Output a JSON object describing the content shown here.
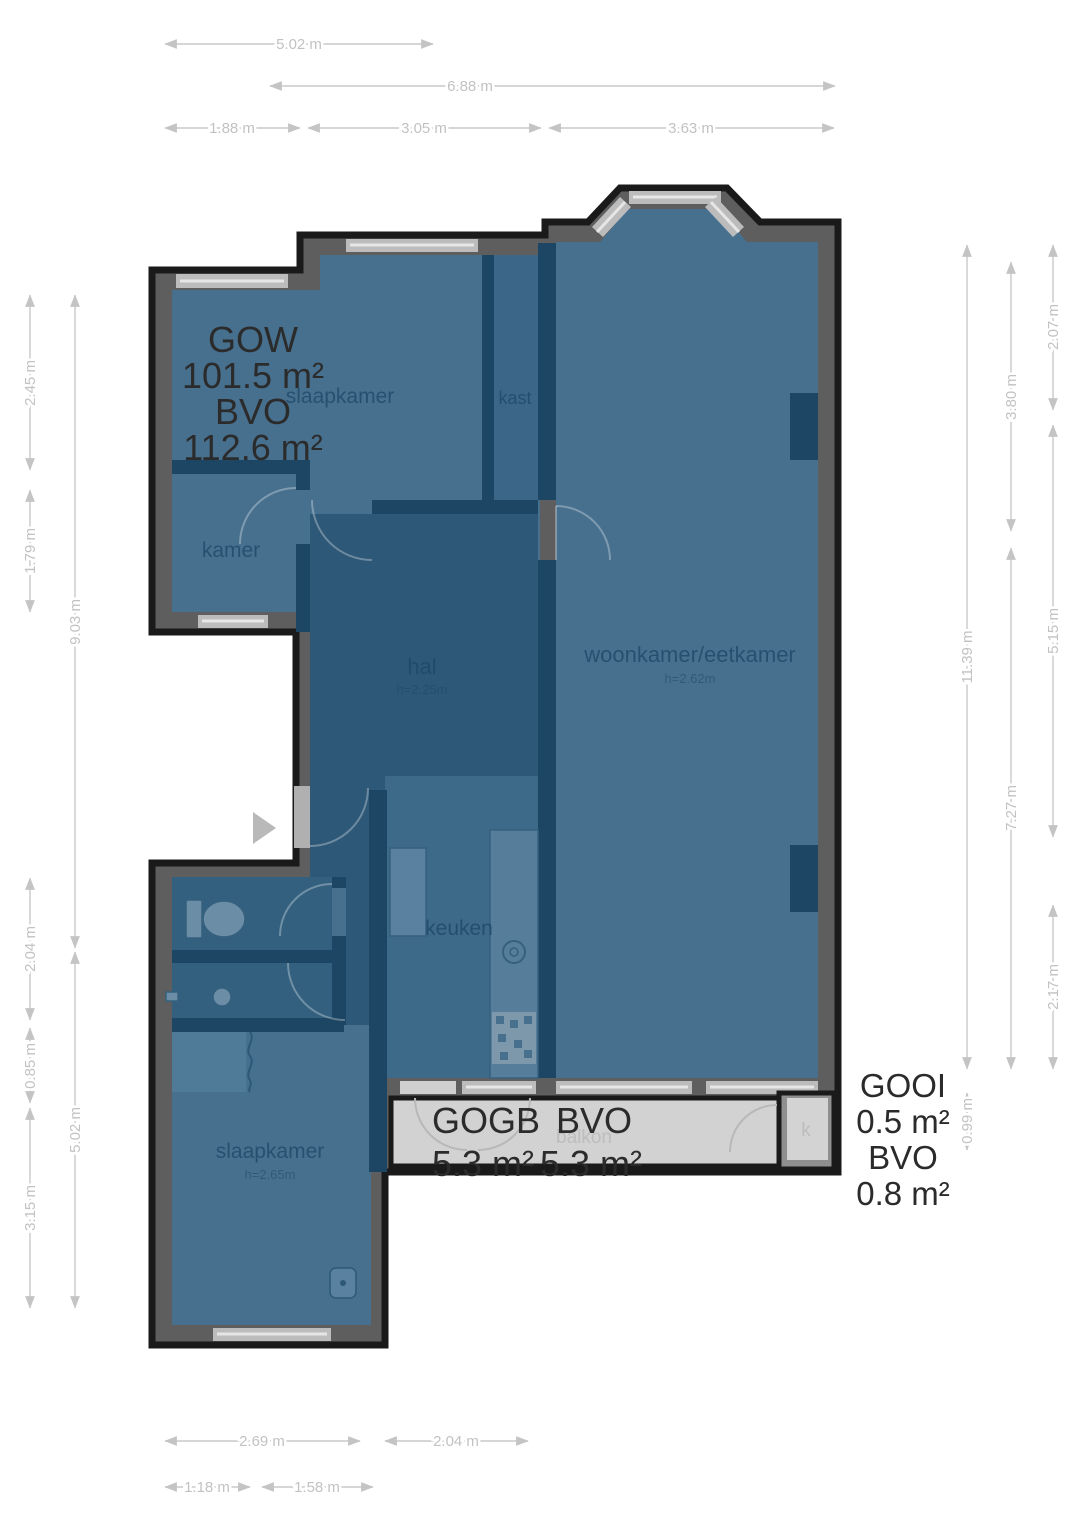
{
  "plan": {
    "area_summary": {
      "gow": [
        "GOW",
        "101.5 m²",
        "BVO",
        "112.6 m²"
      ],
      "gogb": [
        "GOGB",
        "BVO",
        "5.3 m²",
        "5.3 m²"
      ],
      "gooi": [
        "GOOI",
        "0.5 m²",
        "BVO",
        "0.8 m²"
      ]
    },
    "rooms": {
      "slaapkamer_top": {
        "label": "slaapkamer"
      },
      "kast": {
        "label": "kast"
      },
      "kamer": {
        "label": "kamer"
      },
      "hal": {
        "label": "hal",
        "height": "h=2.25m"
      },
      "woonkamer": {
        "label": "woonkamer/eetkamer",
        "height": "h=2.62m"
      },
      "keuken": {
        "label": "keuken"
      },
      "slaapkamer_bottom": {
        "label": "slaapkamer",
        "height": "h=2.65m"
      },
      "balkon": {
        "label": "balkon"
      },
      "berging": {
        "label": "k"
      }
    },
    "dimensions": {
      "top": [
        {
          "label": "5.02 m"
        },
        {
          "label": "6.88 m"
        },
        {
          "label": "1.88 m"
        },
        {
          "label": "3.05 m"
        },
        {
          "label": "3.63 m"
        }
      ],
      "left": [
        {
          "label": "2.45 m"
        },
        {
          "label": "1.79 m"
        },
        {
          "label": "9.03 m"
        },
        {
          "label": "2.04 m"
        },
        {
          "label": "0.85 m"
        },
        {
          "label": "5.02 m"
        },
        {
          "label": "3.15 m"
        }
      ],
      "right": [
        {
          "label": "2.07 m"
        },
        {
          "label": "3.80 m"
        },
        {
          "label": "11.39 m"
        },
        {
          "label": "5.15 m"
        },
        {
          "label": "7.27 m"
        },
        {
          "label": "2.17 m"
        },
        {
          "label": "0.99 m"
        }
      ],
      "bottom": [
        {
          "label": "2.69 m"
        },
        {
          "label": "2.04 m"
        },
        {
          "label": "1.18 m"
        },
        {
          "label": "1.58 m"
        }
      ]
    },
    "colors": {
      "room_fill": "#47708f",
      "hall_fill": "#2e5877",
      "interior_wall": "#1c4663",
      "outer_wall": "#5e5e5e",
      "outline": "#1a1a1a",
      "balcony_fill": "#d2d2d2",
      "dimension_text": "#c4c4c4"
    }
  }
}
